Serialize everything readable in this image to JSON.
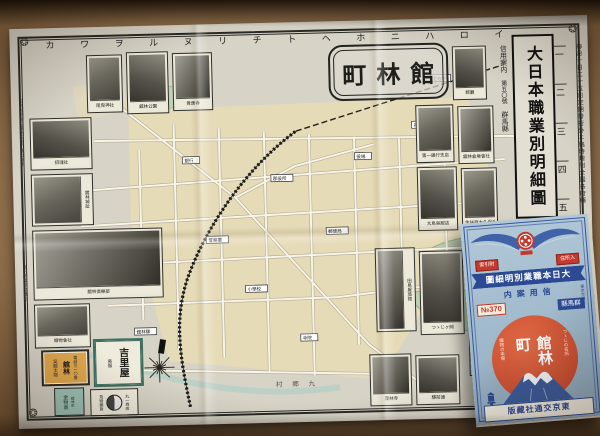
{
  "map_sheet": {
    "cartouche_title": "町林館",
    "main_title": "大日本職業別明細圖",
    "subtitle_lines": [
      "信用案内",
      "第五〇號",
      "群馬縣"
    ],
    "grid_letters": [
      "カ",
      "ワ",
      "ヲ",
      "ル",
      "ヌ",
      "リ",
      "チ",
      "ト",
      "ヘ",
      "ホ",
      "ニ",
      "ハ",
      "ロ",
      "イ"
    ],
    "grid_numbers": [
      "一",
      "二",
      "三",
      "四",
      "五"
    ],
    "right_margin_note": "毎月十日二十五日定期發行外ニ臨時增刊全國各府縣",
    "left_margin_notes": [
      "記號說明官公署學校銀行會社商店",
      "發行所東京交通社"
    ],
    "district_label": "村 郷 九",
    "pond_label": "城沼",
    "rail_label": "至佐野",
    "map_labels": [
      "舘林驛",
      "郡役所",
      "警察署",
      "郵便局",
      "小學校",
      "役場",
      "銀行",
      "寺院",
      "神社"
    ],
    "photos": [
      {
        "caption": "尾曳神社"
      },
      {
        "caption": "舘林公園"
      },
      {
        "caption": "覺應寺"
      },
      {
        "caption": "招魂社"
      },
      {
        "caption": "舘林城趾"
      },
      {
        "caption": "舘林倶樂部"
      },
      {
        "caption": "織物會社"
      },
      {
        "caption": "郡廳"
      },
      {
        "caption": "第一銀行支店"
      },
      {
        "caption": "舘林倉庫會社"
      },
      {
        "caption": "大島吳服店"
      },
      {
        "caption": "生絲商大久保商店"
      },
      {
        "caption": "田島屋旅館"
      },
      {
        "caption": "つゝじヶ岡"
      },
      {
        "caption": "善導寺"
      },
      {
        "caption": "茂林寺"
      },
      {
        "caption": "驛前通"
      }
    ],
    "ads": [
      {
        "line1": "吳服太物",
        "line2": "舘林",
        "line3": "電話三一〇番"
      },
      {
        "name": "吉里屋",
        "side": "吳服"
      },
      {
        "line1": "金物商",
        "line2": "舘林町"
      },
      {
        "line1": "荒物雜貨",
        "line2": "丸一商店"
      }
    ]
  },
  "booklet": {
    "tag_right": "住所入",
    "tag_left": "索引附",
    "title_banner": "圖細明別業職本日大",
    "sub_banner": "内案用信",
    "serial_no": "№370",
    "prefecture": "縣馬群",
    "place_name": "館林町",
    "slogan_right": "つゝじの名所",
    "slogan_left": "織物の本場",
    "publisher": "版藏社通交京東",
    "side_note": "東京交通社"
  }
}
